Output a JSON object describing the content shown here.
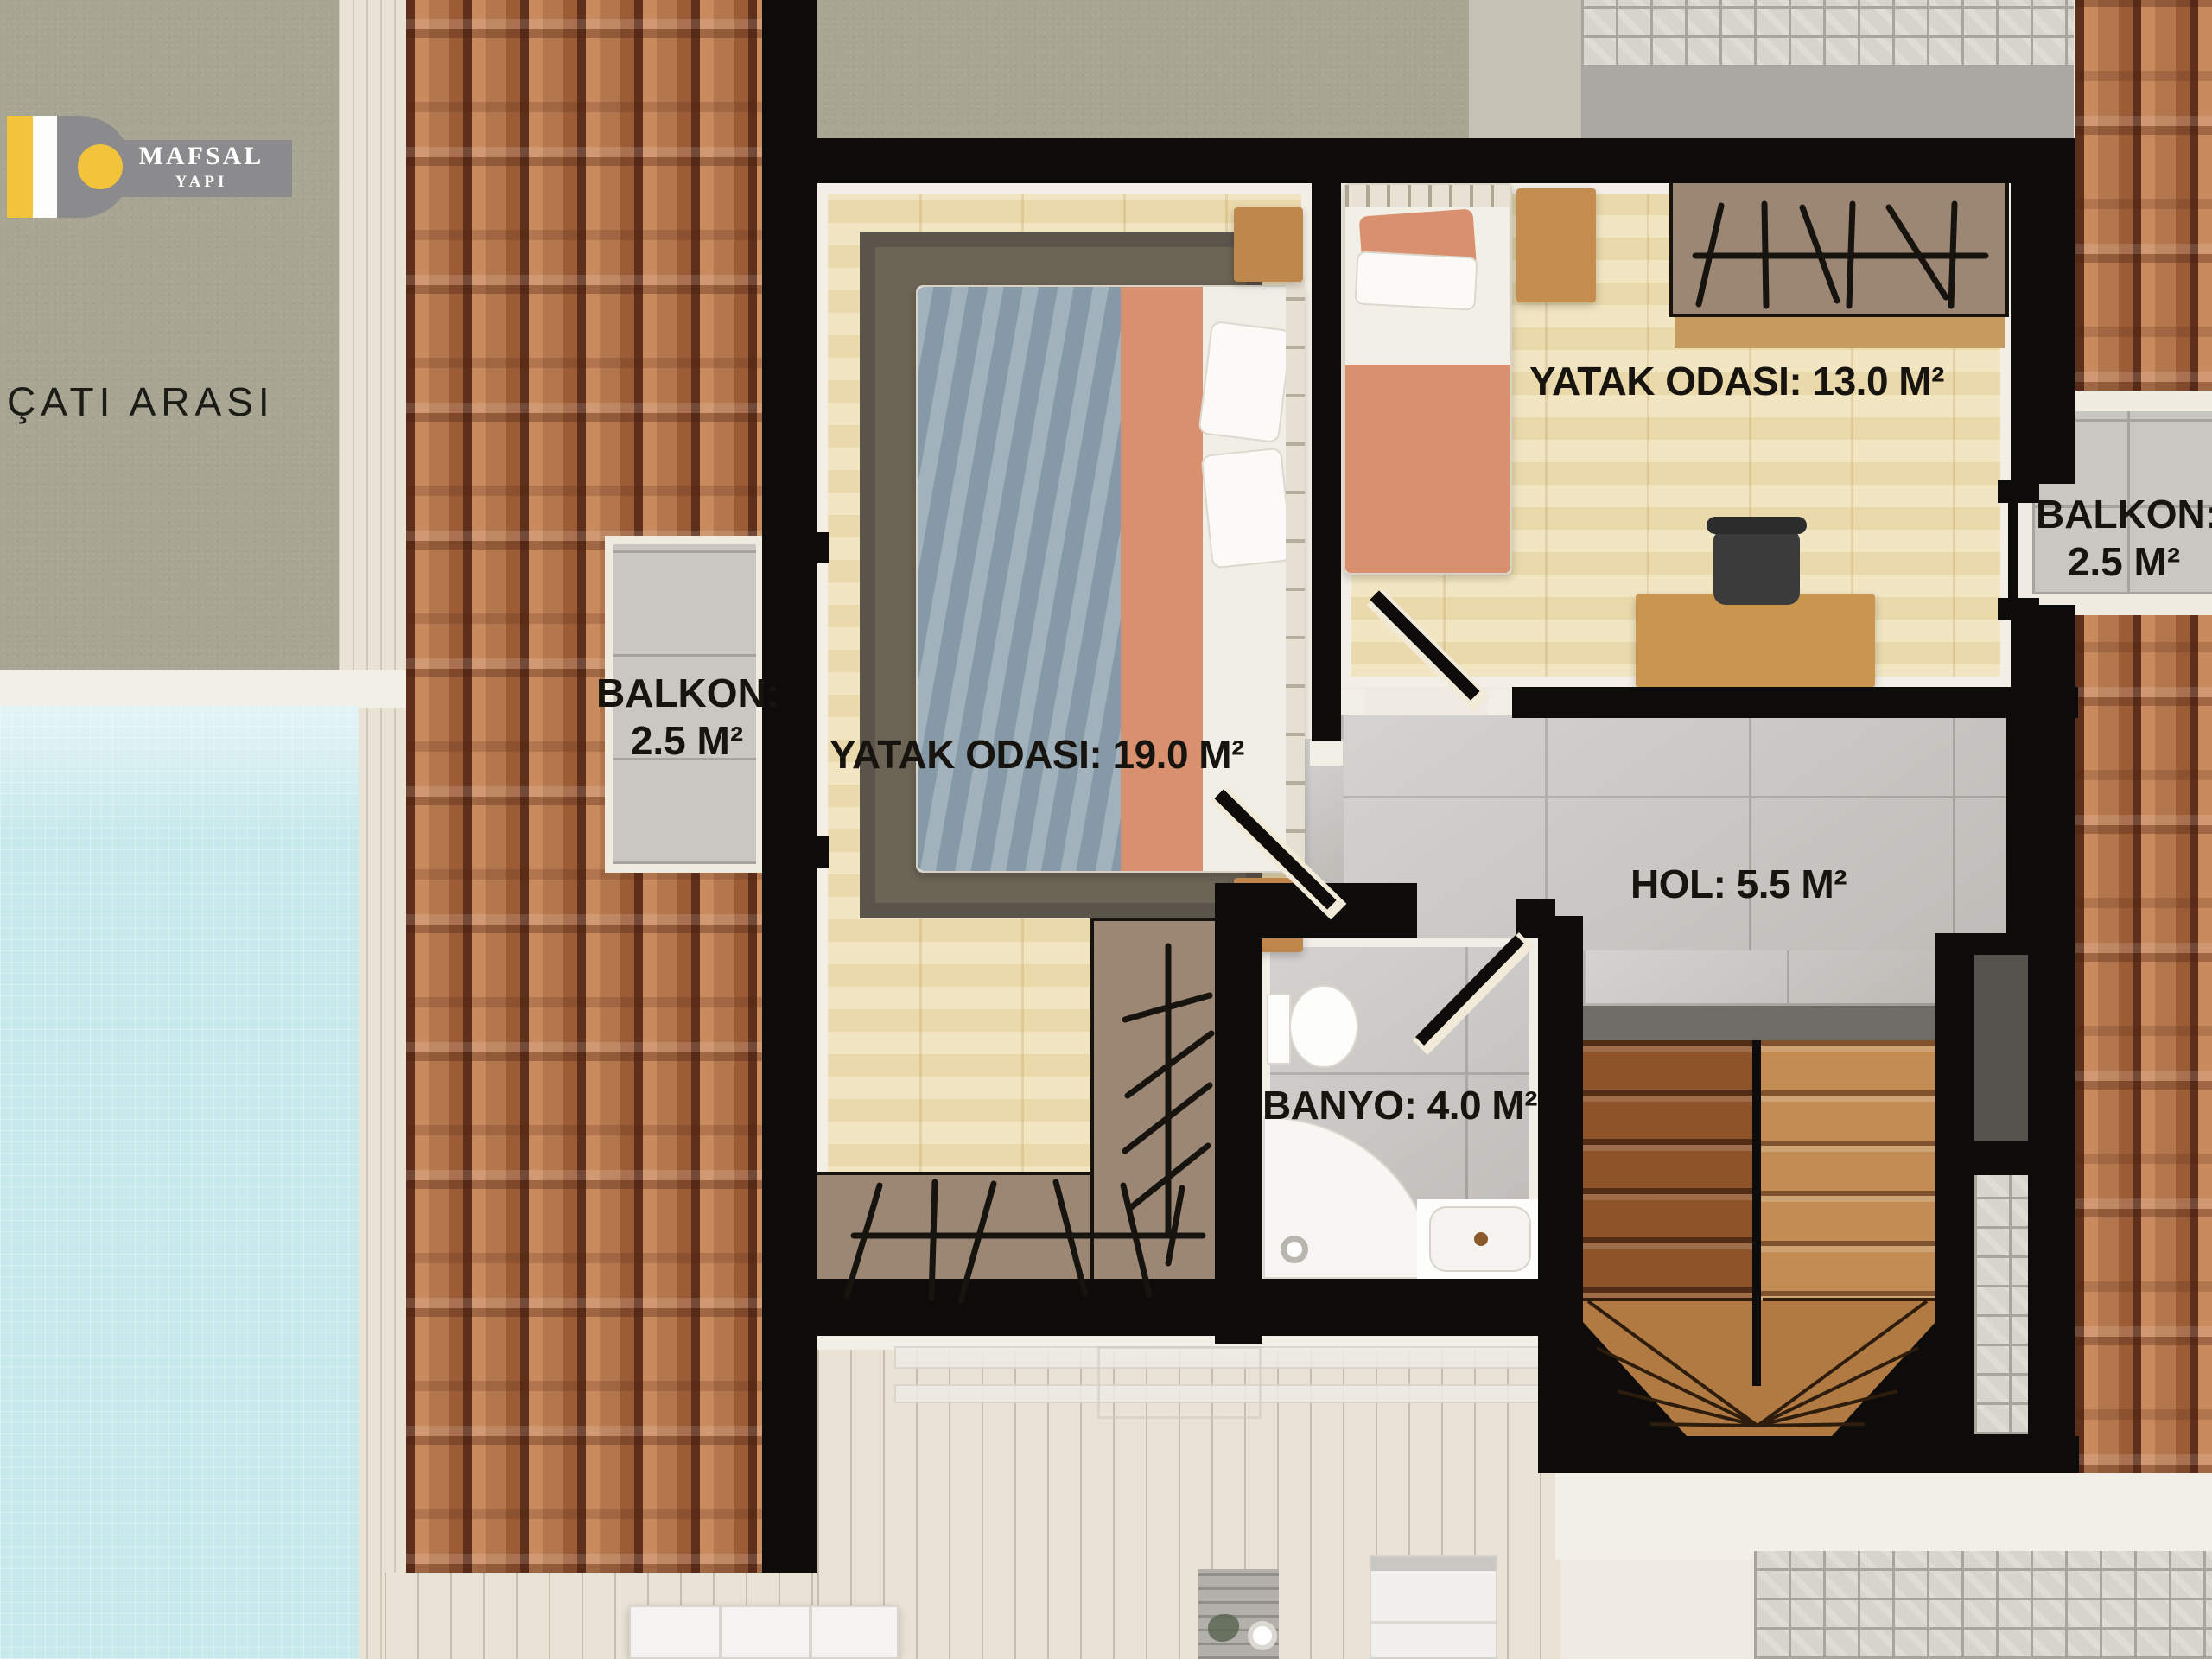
{
  "logo": {
    "brand": "MAFSAL",
    "sub": "YAPI",
    "accent_color": "#f2c43c",
    "banner_color": "#8b8b8d"
  },
  "rooms": {
    "attic": {
      "label": "ÇATI ARASI"
    },
    "bedroom_large": {
      "label": "YATAK ODASI: 19.0 M²",
      "area_m2": 19.0,
      "floor": "wood"
    },
    "bedroom_small": {
      "label": "YATAK ODASI: 13.0 M²",
      "area_m2": 13.0,
      "floor": "wood"
    },
    "hall": {
      "label": "HOL: 5.5 M²",
      "area_m2": 5.5,
      "floor": "gray-tile"
    },
    "bathroom": {
      "label": "BANYO: 4.0 M²",
      "area_m2": 4.0,
      "floor": "gray-tile"
    },
    "balcony_left": {
      "line1": "BALKON:",
      "line2": "2.5 M²",
      "area_m2": 2.5
    },
    "balcony_right": {
      "line1": "BALKON:",
      "line2": "2.5 M²",
      "area_m2": 2.5
    }
  },
  "colors": {
    "wall_black": "#0e0c0a",
    "roof_terracotta": "#b4764c",
    "wood_floor": "#efe1b6",
    "tile_gray": "#c9c6c2",
    "pool_blue": "#c7e9ec",
    "olive_roof": "#a8a592",
    "closet_taupe": "#9c8775",
    "bed_salmon": "#d8906f",
    "bed_gray_blue": "#93a6b2",
    "deck_wood": "#eae2d5"
  }
}
